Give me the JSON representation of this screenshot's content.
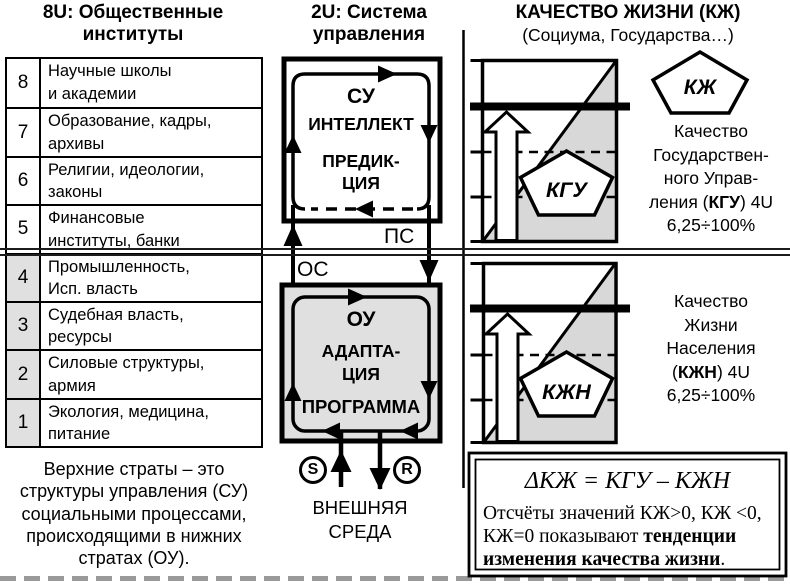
{
  "left_column": {
    "title": "8U: Общественные\nинституты",
    "strata_table": {
      "rows": [
        {
          "num": "8",
          "line1": "Научные школы",
          "line2": "и академии"
        },
        {
          "num": "7",
          "line1": "Образование, кадры,",
          "line2": "архивы"
        },
        {
          "num": "6",
          "line1": "Религии, идеологии,",
          "line2": "законы"
        },
        {
          "num": "5",
          "line1": "Финансовые",
          "line2": "институты, банки"
        },
        {
          "num": "4",
          "line1": "Промышленность,",
          "line2": "Исп. власть"
        },
        {
          "num": "3",
          "line1": "Судебная власть,",
          "line2": "ресурсы"
        },
        {
          "num": "2",
          "line1": "Силовые структуры,",
          "line2": "армия"
        },
        {
          "num": "1",
          "line1": "Экология, медицина,",
          "line2": "питание"
        }
      ]
    },
    "note": "Верхние страты – это\nструктуры управления (СУ)\nсоциальными процессами,\nпроисходящими в нижних\nстратах (ОУ)."
  },
  "control_column": {
    "title": "2U: Система\nуправления",
    "su_box": {
      "name": "СУ",
      "line2": "ИНТЕЛЛЕКТ",
      "line3": "ПРЕДИК-\nЦИЯ"
    },
    "ou_box": {
      "name": "ОУ",
      "line2": "АДАПТА-\nЦИЯ",
      "line3": "ПРОГРАММА"
    },
    "ps_label": "ПС",
    "os_label": "ОС",
    "s_label": "S",
    "r_label": "R",
    "environment": "ВНЕШНЯЯ\nСРЕДА"
  },
  "quality_column": {
    "heading": "КАЧЕСТВО ЖИЗНИ (КЖ)",
    "subheading": "(Социума, Государства…)",
    "kj_pentagon_label": "КЖ",
    "kgu": {
      "pentagon_label": "КГУ",
      "caption": [
        "Качество",
        "Государствен-",
        "ного Управ-"
      ],
      "caption_mid_pre": "ления (",
      "caption_mid_bold": "КГУ",
      "caption_mid_post": ") 4U",
      "caption_last": "6,25÷100%"
    },
    "kjn": {
      "pentagon_label": "КЖН",
      "caption": [
        "Качество",
        "Жизни",
        "Населения"
      ],
      "caption_mid_pre": "(",
      "caption_mid_bold": "КЖН",
      "caption_mid_post": ") 4U",
      "caption_last": "6,25÷100%"
    },
    "formula_box": {
      "formula": "ΔКЖ = КГУ – КЖН",
      "line2": "Отсчёты значений КЖ>0, КЖ <0,",
      "line3_pre": "КЖ=0 показывают ",
      "line3_bold": "тенденции",
      "line4_bold": "изменения качества жизни",
      "line4_post": "."
    }
  },
  "colors": {
    "box-fill": "#e0e0e0",
    "chart-shade": "#d8d8d8",
    "line": "#000000",
    "cut-dash": "#9a9a9a"
  }
}
